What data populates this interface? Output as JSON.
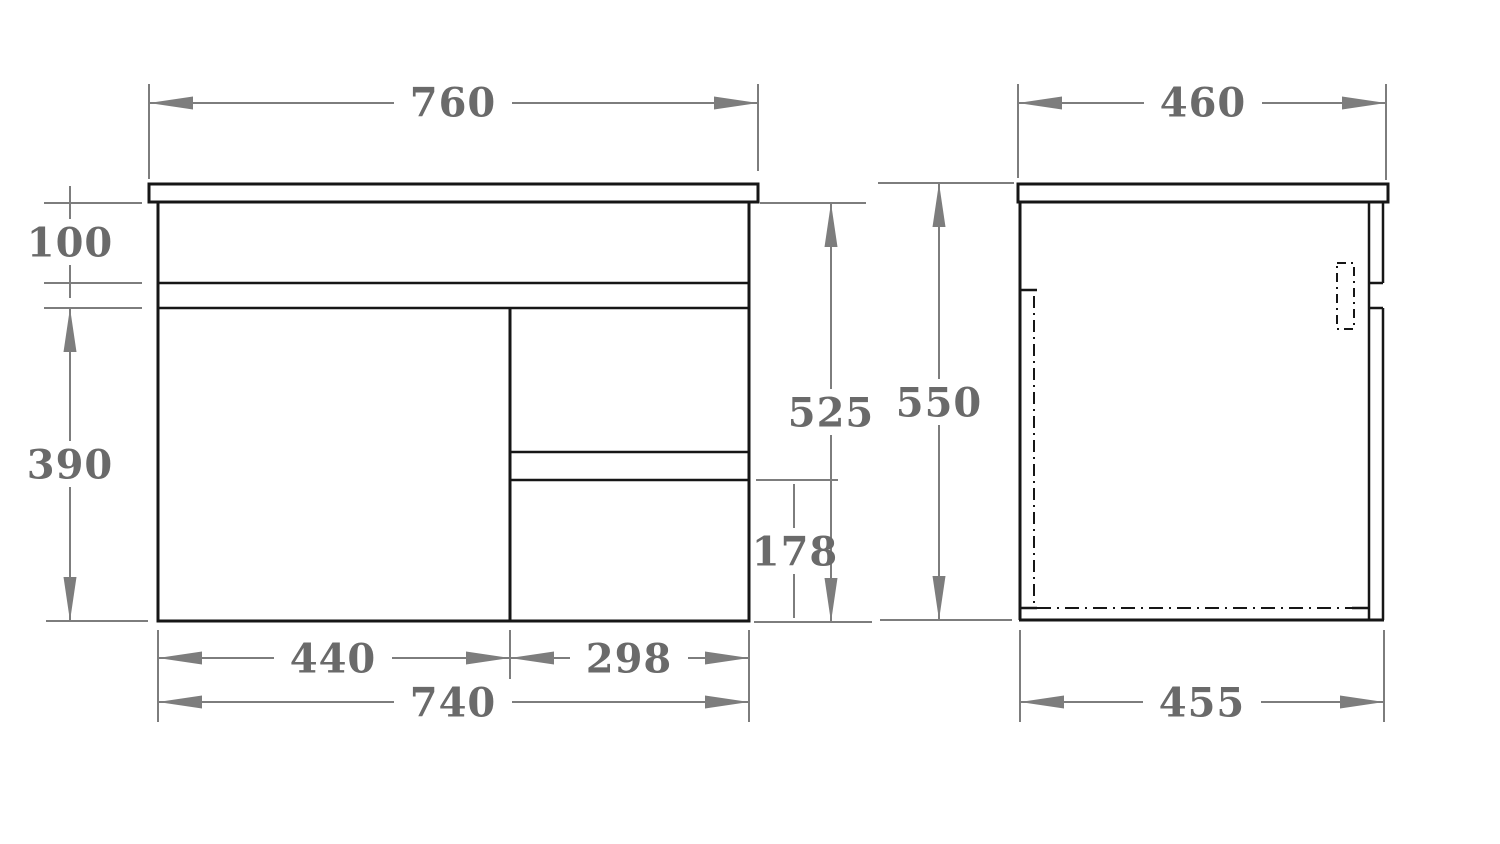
{
  "drawing": {
    "type": "technical dimension drawing",
    "subject": "wall-hung vanity cabinet with door and two drawers, front and side views",
    "units": "mm"
  },
  "colors": {
    "background": "#ffffff",
    "outline": "#161616",
    "dimension_lines": "#7d7d7d",
    "label_text": "#6a6a6a"
  },
  "front_view": {
    "name": "front-view",
    "dims": {
      "top_width": "760",
      "apron_height": "100",
      "door_height": "390",
      "cabinet_height": "525",
      "bottom_drawer_height": "178",
      "door_width": "440",
      "drawers_width": "298",
      "cabinet_width": "740"
    }
  },
  "side_view": {
    "name": "side-view",
    "dims": {
      "top_depth": "460",
      "overall_height": "550",
      "cabinet_depth": "455"
    }
  }
}
